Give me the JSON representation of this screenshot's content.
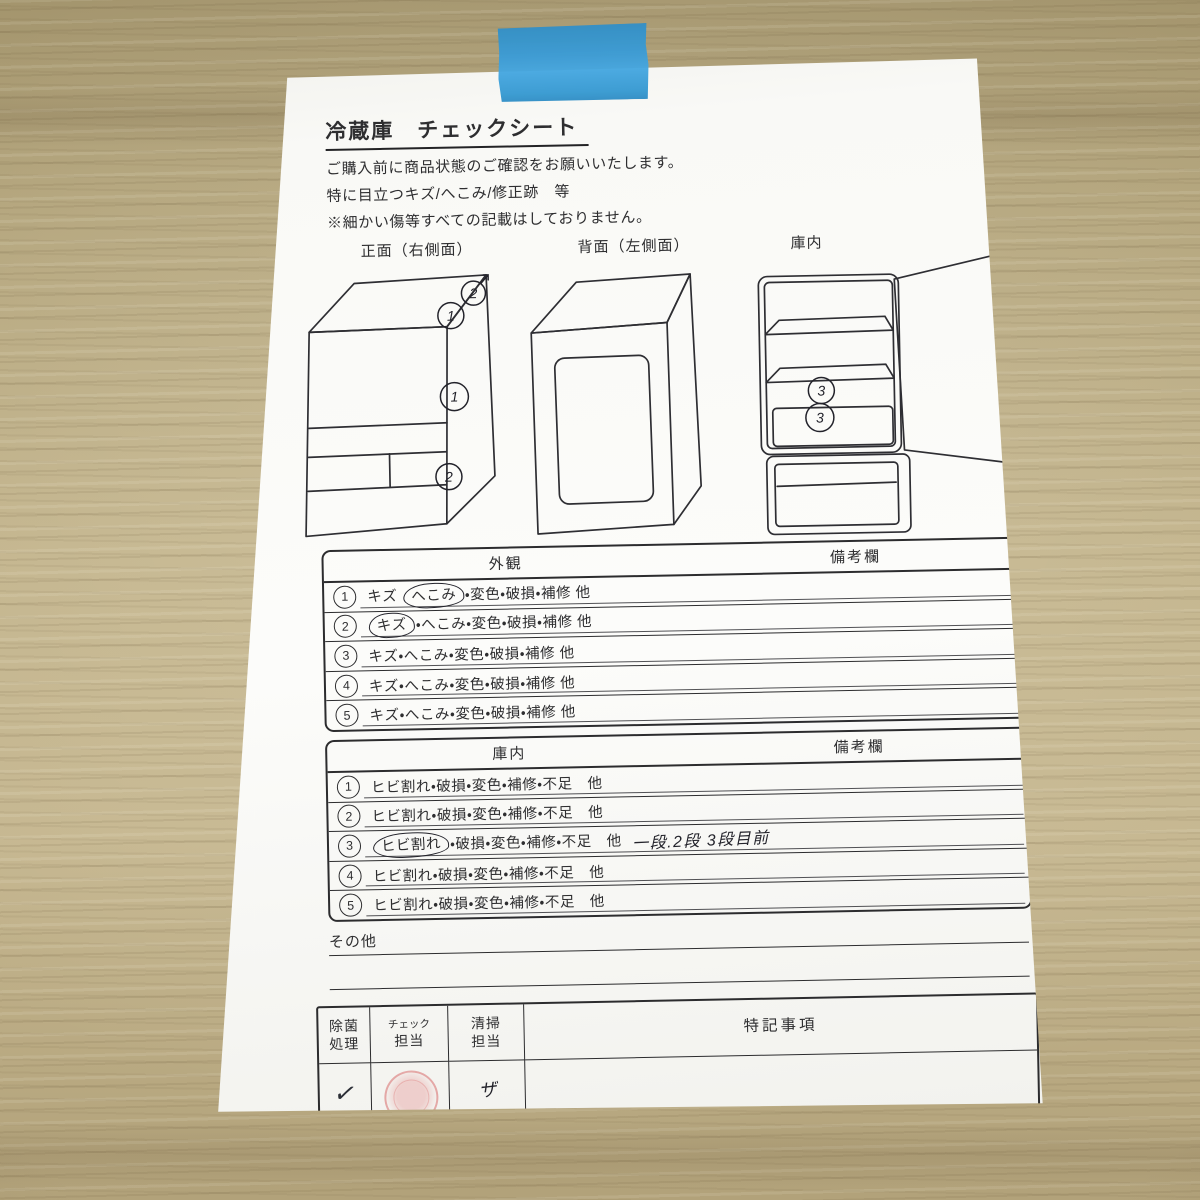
{
  "photo": {
    "colors": {
      "wood": "#b5a47c",
      "paper": "#f9f9f6",
      "tape_blue": "#3b9cd6",
      "ink": "#2e2e30",
      "handwriting_ink": "#23232b",
      "stamp_red": "#d66060"
    }
  },
  "document": {
    "title": "冷蔵庫　チェックシート",
    "intro_lines": [
      "ご購入前に商品状態のご確認をお願いいたします。",
      "特に目立つキズ/へこみ/修正跡　等",
      "※細かい傷等すべての記載はしておりません。"
    ],
    "diagrams": {
      "front_label": "正面（右側面）",
      "back_label": "背面（左側面）",
      "interior_label": "庫内",
      "front_corner_marks": [
        "1",
        "2"
      ],
      "front_side_mark": "1",
      "front_bottom_mark": "2",
      "interior_marks": [
        "3",
        "3"
      ]
    },
    "exterior_table": {
      "header_left": "外観",
      "header_right": "備考欄",
      "rows": [
        {
          "num": "1",
          "pre": "キズ ",
          "circled": "へこみ",
          "post": "・変色・破損・補修 他",
          "note": ""
        },
        {
          "num": "2",
          "pre": "",
          "circled": "キズ",
          "post": "・へこみ・変色・破損・補修 他",
          "note": ""
        },
        {
          "num": "3",
          "pre": "キズ・へこみ・変色・破損・補修 他",
          "circled": "",
          "post": "",
          "note": ""
        },
        {
          "num": "4",
          "pre": "キズ・へこみ・変色・破損・補修 他",
          "circled": "",
          "post": "",
          "note": ""
        },
        {
          "num": "5",
          "pre": "キズ・へこみ・変色・破損・補修 他",
          "circled": "",
          "post": "",
          "note": ""
        }
      ]
    },
    "interior_table": {
      "header_left": "庫内",
      "header_right": "備考欄",
      "rows": [
        {
          "num": "1",
          "pre": "ヒビ割れ・破損・変色・補修・不足　他",
          "circled": "",
          "post": "",
          "note": ""
        },
        {
          "num": "2",
          "pre": "ヒビ割れ・破損・変色・補修・不足　他",
          "circled": "",
          "post": "",
          "note": ""
        },
        {
          "num": "3",
          "pre": "",
          "circled": "ヒビ割れ",
          "post": "・破損・変色・補修・不足　他",
          "note": "一段.2段 3段目前"
        },
        {
          "num": "4",
          "pre": "ヒビ割れ・破損・変色・補修・不足　他",
          "circled": "",
          "post": "",
          "note": ""
        },
        {
          "num": "5",
          "pre": "ヒビ割れ・破損・変色・補修・不足　他",
          "circled": "",
          "post": "",
          "note": ""
        }
      ]
    },
    "other_label": "その他",
    "sign_table": {
      "col1_header": [
        "除菌",
        "処理"
      ],
      "col2_header": [
        "チェック",
        "担当"
      ],
      "col3_header": [
        "清掃",
        "担当"
      ],
      "col4_header": "特記事項",
      "col1_value": "✓",
      "col3_value": "ザ"
    }
  }
}
